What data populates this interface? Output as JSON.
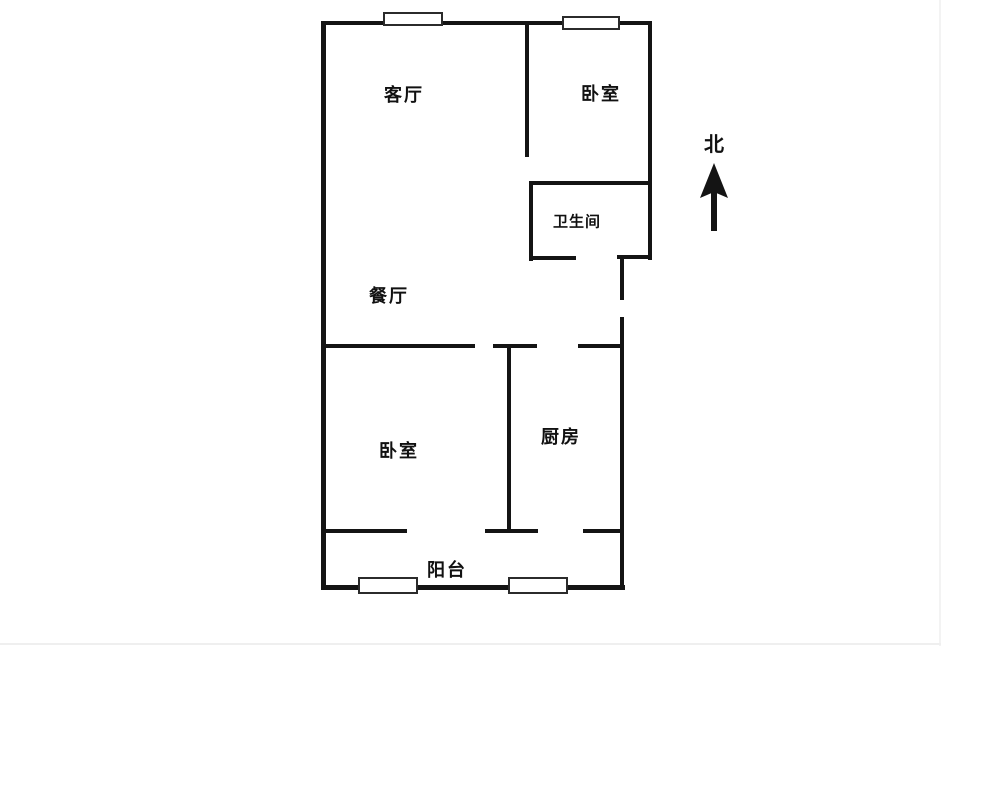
{
  "document": {
    "type": "apartment-floor-plan"
  },
  "rooms": {
    "living": {
      "label": "客厅"
    },
    "bedroom_top": {
      "label": "卧室"
    },
    "bathroom": {
      "label": "卫生间"
    },
    "dining": {
      "label": "餐厅"
    },
    "bedroom_bottom": {
      "label": "卧室"
    },
    "kitchen": {
      "label": "厨房"
    },
    "balcony": {
      "label": "阳台"
    }
  },
  "compass": {
    "label": "北",
    "direction": "up"
  },
  "colors": {
    "wall": "#141414",
    "background": "#ffffff",
    "window_fill": "#ffffff",
    "window_border": "#2b2b2b",
    "text": "#111111"
  }
}
